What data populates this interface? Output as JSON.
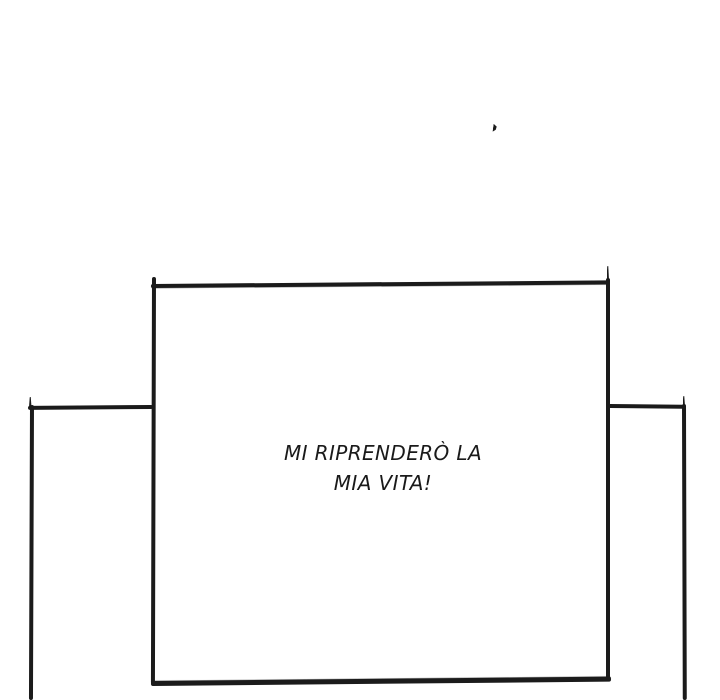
{
  "colors": {
    "background": "#ffffff",
    "ink": "#1b1b1b",
    "text": "#1a1a1a"
  },
  "speech": {
    "line1": "MI RIPRENDERÒ LA",
    "line2": "MIA VITA!"
  }
}
